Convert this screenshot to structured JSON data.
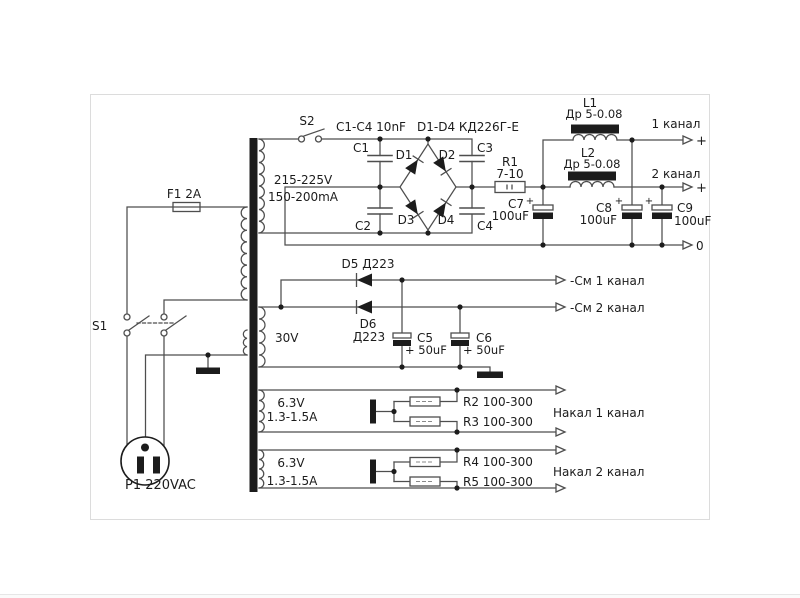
{
  "colors": {
    "ink": "#1c1c1c",
    "wire": "#4e4e4e",
    "panel": "#dcdcdc",
    "bg": "#ffffff"
  },
  "schematic": {
    "mains": {
      "s1": "S1",
      "f1": "F1 2A",
      "p1": "P1 220VAC"
    },
    "hv": {
      "s2": "S2",
      "cap_group": "C1-C4 10nF",
      "diode_group": "D1-D4 КД226Г-Е",
      "winding_v": "215-225V",
      "winding_i": "150-200mA",
      "c1": "C1",
      "c2": "C2",
      "c3": "C3",
      "c4": "C4",
      "d1": "D1",
      "d2": "D2",
      "d3": "D3",
      "d4": "D4",
      "r1": "R1",
      "r1_val": "7-10",
      "l1": "L1",
      "l1_val": "Др 5-0.08",
      "l2": "L2",
      "l2_val": "Др 5-0.08",
      "c7": "C7",
      "c7_val": "100uF",
      "c8": "C8",
      "c8_val": "100uF",
      "c9": "C9",
      "c9_val": "100uF",
      "plus": "+",
      "out1": "1 канал",
      "out2": "2 канал",
      "out_zero": "0"
    },
    "bias": {
      "winding": "30V",
      "d5": "D5 Д223",
      "d6": "D6",
      "d6_val": "Д223",
      "c5": "C5",
      "c5_val": "+ 50uF",
      "c6": "C6",
      "c6_val": "+ 50uF",
      "out1": "-См 1 канал",
      "out2": "-См 2 канал"
    },
    "heater1": {
      "winding_v": "6.3V",
      "winding_i": "1.3-1.5A",
      "r_top": "R2 100-300",
      "r_bottom": "R3 100-300",
      "out": "Накал 1 канал"
    },
    "heater2": {
      "winding_v": "6.3V",
      "winding_i": "1.3-1.5A",
      "r_top": "R4 100-300",
      "r_bottom": "R5 100-300",
      "out": "Накал 2 канал"
    }
  }
}
